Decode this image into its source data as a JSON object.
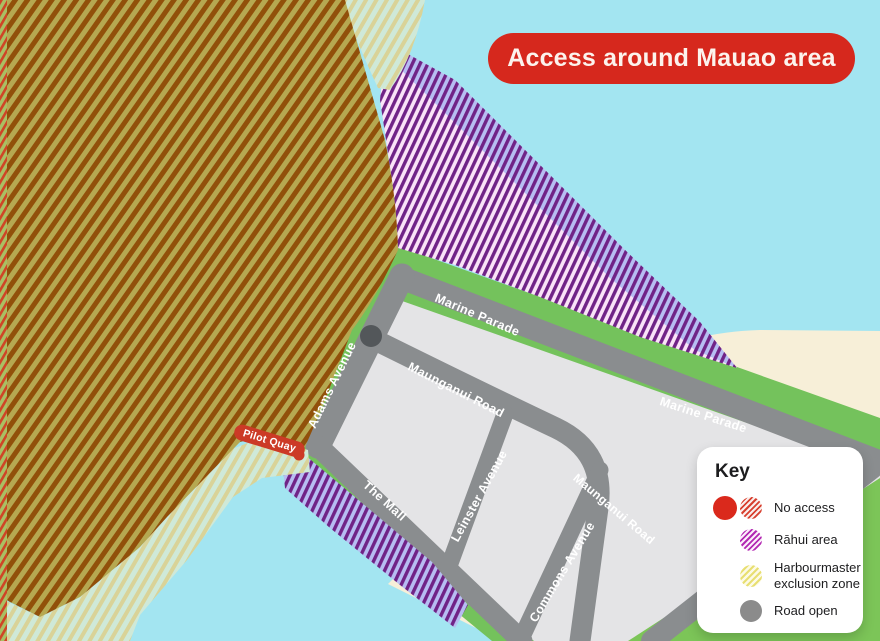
{
  "banner": {
    "title": "Access around Mauao area"
  },
  "map": {
    "labels": {
      "marine_parade_1": "Marine Parade",
      "marine_parade_2": "Marine Parade",
      "maunganui_road_1": "Maunganui Road",
      "maunganui_road_2": "Maunganui Road",
      "adams_avenue": "Adams Avenue",
      "the_mall": "The Mall",
      "leinster_avenue": "Leinster Avenue",
      "commons_avenue": "Commons Avenue",
      "pilot_quay": "Pilot Quay"
    },
    "areas": {
      "no_access": "No access hatched area over Mauao",
      "rahui_north": "Rāhui hatched area along Marine Parade shoreline",
      "rahui_south": "Rāhui hatched area along The Mall waterfront",
      "exclusion_zone": "Harbourmaster exclusion zone hatched band around Mauao waterline"
    }
  },
  "key": {
    "title": "Key",
    "items": [
      {
        "label": "No access"
      },
      {
        "label": "Rāhui area"
      },
      {
        "label": "Harbourmaster exclusion zone"
      },
      {
        "label": "Road open"
      }
    ]
  },
  "colors": {
    "banner_red": "#d6281d",
    "no_access_red": "#da291c",
    "no_access_stripe_brown": "#91500a",
    "rahui_purple": "#702387",
    "exclusion_yellow": "#e8df72",
    "road_gray": "#8a8d8f",
    "water_cyan": "#a3e5f1",
    "sand_cream": "#f7efd8",
    "land_green": "#74c25c"
  }
}
